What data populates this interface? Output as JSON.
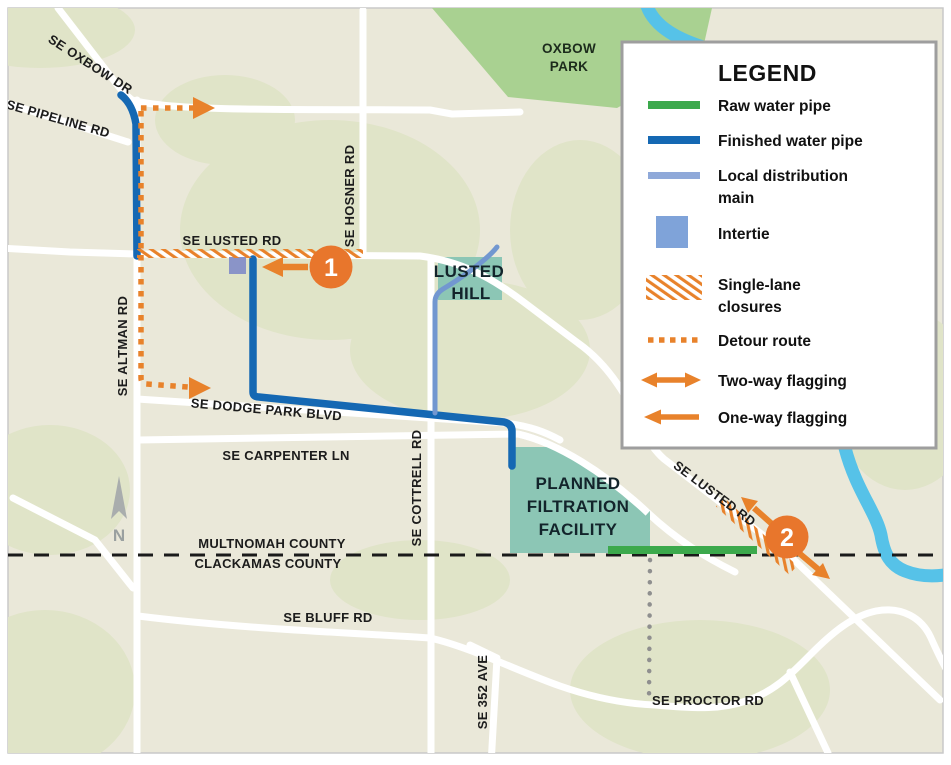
{
  "map": {
    "roads": {
      "oxbow_dr": "SE OXBOW DR",
      "pipeline_rd": "SE PIPELINE RD",
      "altman_rd": "SE ALTMAN RD",
      "lusted_rd_west": "SE LUSTED RD",
      "hosner_rd": "SE HOSNER RD",
      "dodge_park_blvd": "SE DODGE PARK BLVD",
      "carpenter_ln": "SE CARPENTER LN",
      "cottrell_rd": "SE COTTRELL RD",
      "bluff_rd": "SE BLUFF RD",
      "ave_352": "SE 352 AVE",
      "proctor_rd": "SE PROCTOR RD",
      "lusted_rd_east": "SE LUSTED RD"
    },
    "areas": {
      "oxbow_park_line1": "OXBOW",
      "oxbow_park_line2": "PARK",
      "lusted_hill_line1": "LUSTED",
      "lusted_hill_line2": "HILL",
      "facility_line1": "PLANNED",
      "facility_line2": "FILTRATION",
      "facility_line3": "FACILITY"
    },
    "county_line1": "MULTNOMAH COUNTY",
    "county_line2": "CLACKAMAS COUNTY",
    "north_label": "N",
    "markers": {
      "m1": "1",
      "m2": "2"
    }
  },
  "legend": {
    "title": "LEGEND",
    "items": [
      {
        "key": "raw-water-pipe",
        "label": "Raw water pipe"
      },
      {
        "key": "finished-water-pipe",
        "label": "Finished water pipe"
      },
      {
        "key": "local-distribution-main",
        "label": "Local distribution",
        "label2": "main"
      },
      {
        "key": "intertie",
        "label": "Intertie"
      },
      {
        "key": "single-lane-closures",
        "label": "Single-lane",
        "label2": "closures"
      },
      {
        "key": "detour-route",
        "label": "Detour route"
      },
      {
        "key": "two-way-flagging",
        "label": "Two-way flagging"
      },
      {
        "key": "one-way-flagging",
        "label": "One-way flagging"
      }
    ]
  },
  "colors": {
    "background": "#EAE8D9",
    "light_green_patch": "#E0E4C8",
    "park_green": "#A9D191",
    "facility_teal": "#8CC6B5",
    "river_blue": "#56C2E8",
    "road_white": "#FFFFFF",
    "raw_water_pipe": "#3CA94C",
    "finished_water_pipe": "#1568B3",
    "local_distribution_main": "#8FA9D9",
    "intertie": "#7FA3D9",
    "intertie_map": "#8A94C8",
    "construction_orange": "#E8822B",
    "marker_orange": "#E8762C",
    "county_line_black": "#1a1a1a",
    "dotted_gray": "#8F8F8F",
    "north_arrow_gray": "#A9ADAD"
  }
}
